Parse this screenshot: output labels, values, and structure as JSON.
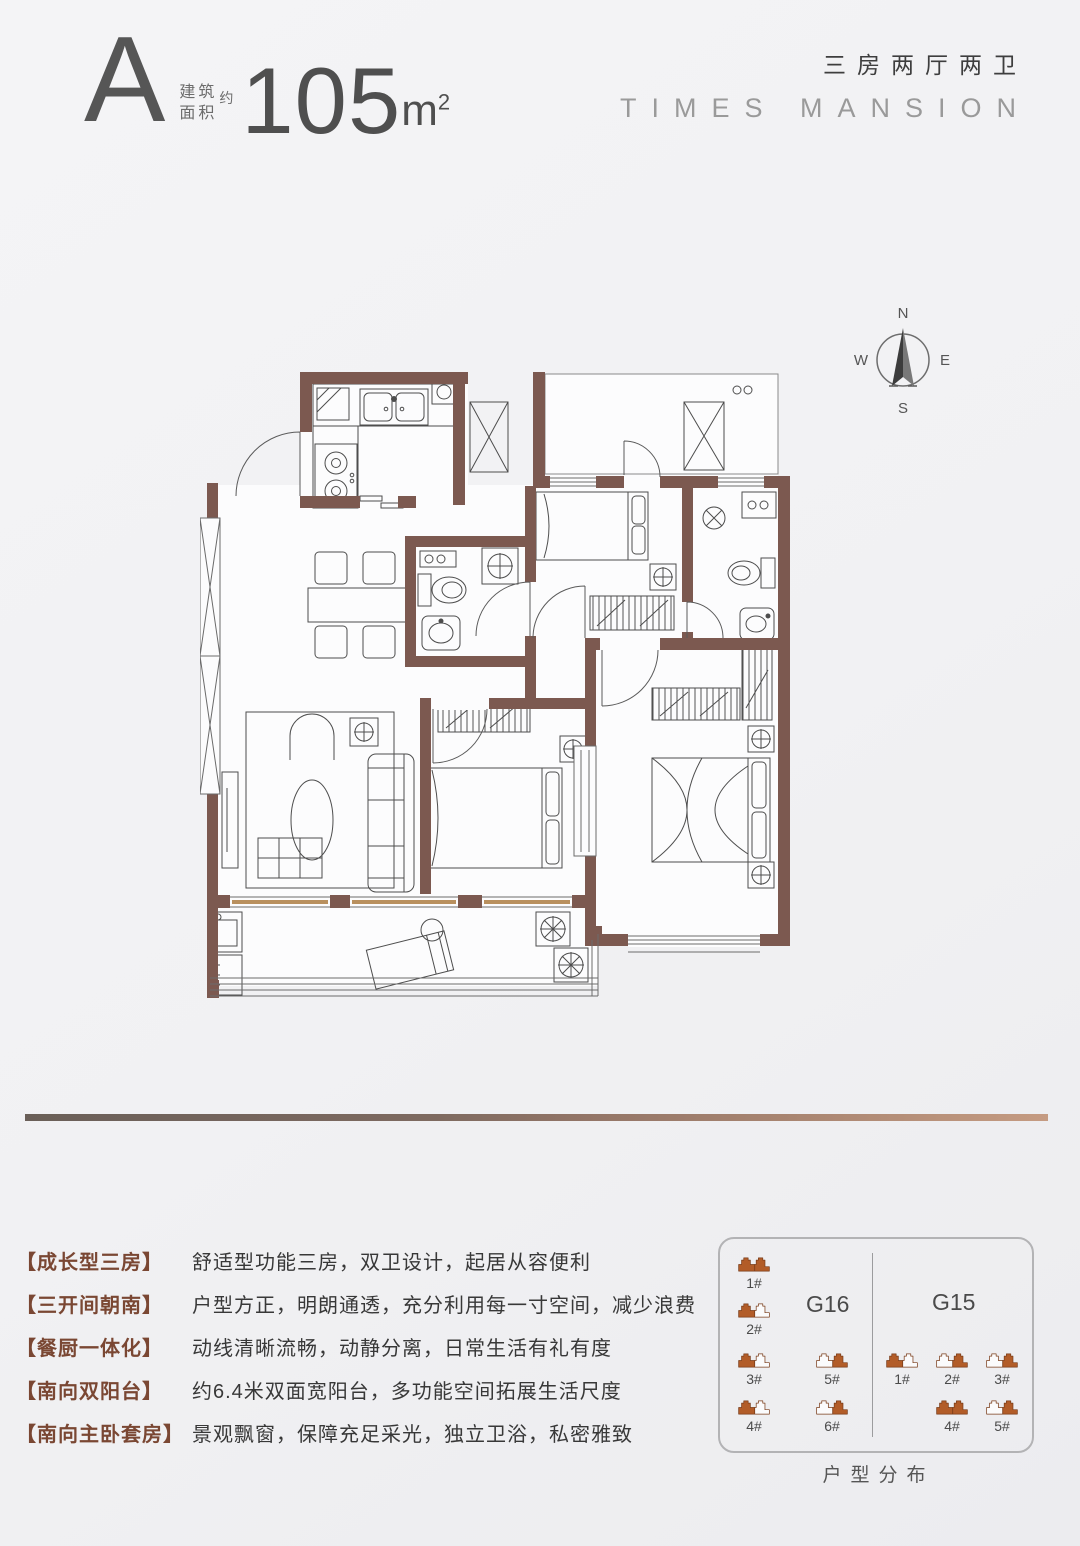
{
  "header": {
    "unit": "A",
    "area_label_1": "建筑",
    "area_label_2": "面积",
    "approx": "约",
    "area": "105",
    "unit_suffix": "m",
    "sup": "2",
    "layout": "三房两厅两卫",
    "brand": "TIMES MANSION"
  },
  "compass": {
    "n": "N",
    "e": "E",
    "s": "S",
    "w": "W"
  },
  "features": [
    {
      "label": "【成长型三房】",
      "text": "舒适型功能三房，双卫设计，起居从容便利"
    },
    {
      "label": "【三开间朝南】",
      "text": "户型方正，明朗通透，充分利用每一寸空间，减少浪费"
    },
    {
      "label": "【餐厨一体化】",
      "text": "动线清晰流畅，动静分离，日常生活有礼有度"
    },
    {
      "label": "【南向双阳台】",
      "text": "约6.4米双面宽阳台，多功能空间拓展生活尺度"
    },
    {
      "label": "【南向主卧套房】",
      "text": "景观飘窗，保障充足采光，独立卫浴，私密雅致"
    }
  ],
  "distribution": {
    "caption": "户型分布",
    "groups": [
      {
        "name": "G16",
        "buildings": [
          {
            "id": "1#",
            "variant": "full"
          },
          {
            "id": "2#",
            "variant": "left"
          },
          {
            "id": "3#",
            "variant": "left"
          },
          {
            "id": "5#",
            "variant": "right"
          },
          {
            "id": "4#",
            "variant": "left"
          },
          {
            "id": "6#",
            "variant": "right"
          }
        ]
      },
      {
        "name": "G15",
        "buildings": [
          {
            "id": "1#",
            "variant": "left"
          },
          {
            "id": "2#",
            "variant": "right"
          },
          {
            "id": "3#",
            "variant": "right"
          },
          {
            "id": "4#",
            "variant": "full"
          },
          {
            "id": "5#",
            "variant": "right"
          }
        ]
      }
    ]
  },
  "colors": {
    "wall_brown": "#7c5950",
    "building_icon": "#b25c28",
    "feature_label": "#7a4733",
    "divider_left": "#6a5f58",
    "divider_right": "#c59b82",
    "background": "#f2f2f4"
  }
}
